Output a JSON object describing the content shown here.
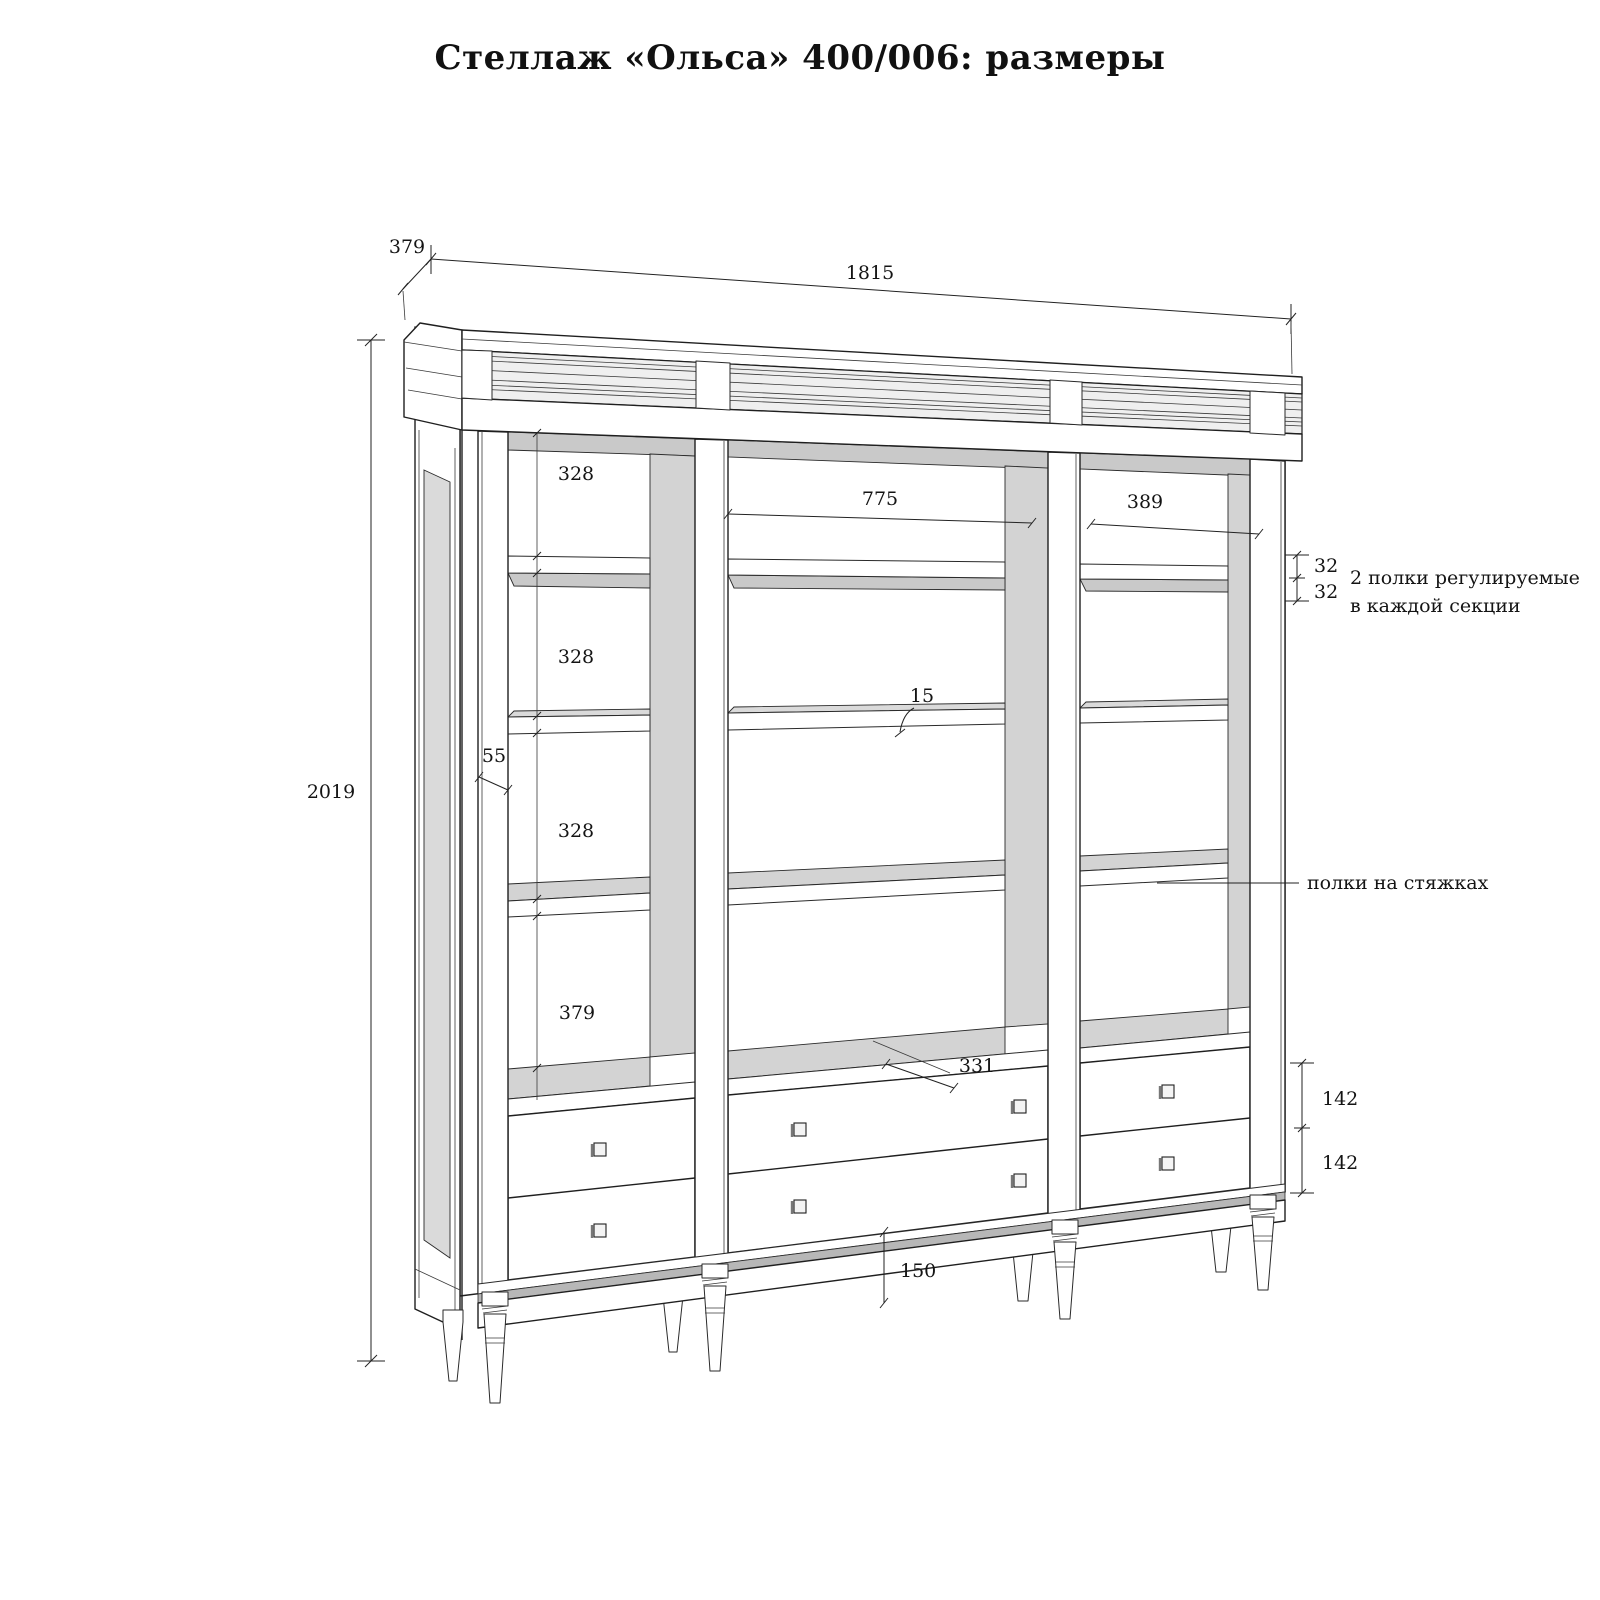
{
  "title": "Стеллаж «Ольса»  400/006: размеры",
  "dims": {
    "depth": "379",
    "width": "1815",
    "height": "2019",
    "left_bay": {
      "s1": "328",
      "s2": "328",
      "s3": "328",
      "s4": "379"
    },
    "stile_width": "55",
    "mid_width": "775",
    "right_width": "389",
    "adj_gap_a": "32",
    "adj_gap_b": "32",
    "shelf_thickness": "15",
    "deck_depth": "331",
    "drawer_a": "142",
    "drawer_b": "142",
    "leg_height": "150"
  },
  "notes": {
    "adjustable_line1": "2 полки регулируемые",
    "adjustable_line2": "в каждой секции",
    "shelves_on_ties": "полки на стяжках"
  }
}
